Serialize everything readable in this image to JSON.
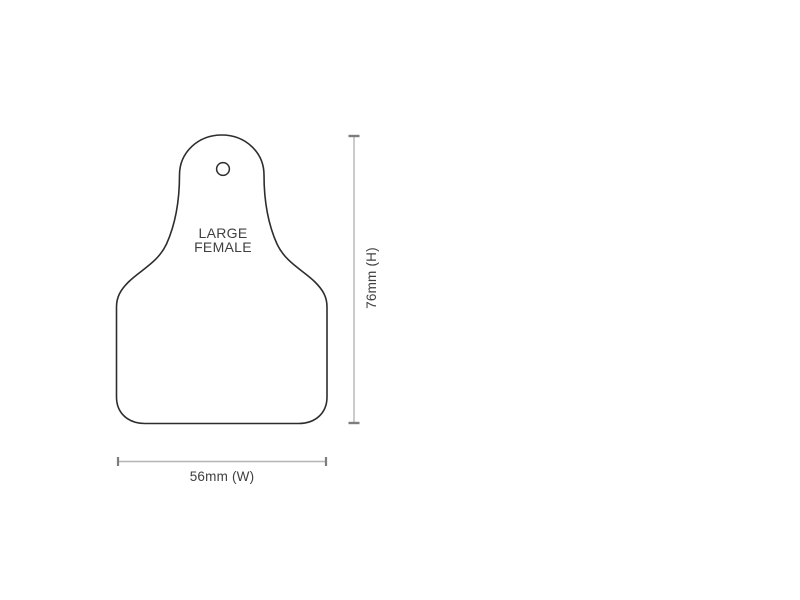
{
  "diagram": {
    "tag": {
      "label_line1": "LARGE",
      "label_line2": "FEMALE"
    },
    "dimensions": {
      "height_label": "76mm (H)",
      "width_label": "56mm (W)"
    },
    "colors": {
      "background": "#ffffff",
      "tag_outline": "#2d2d2d",
      "pin_hole_outline": "#2d2d2d",
      "label_text": "#3f3f3f",
      "dimension_line": "#b5b5b5",
      "dimension_tick": "#7d7d7d"
    }
  }
}
